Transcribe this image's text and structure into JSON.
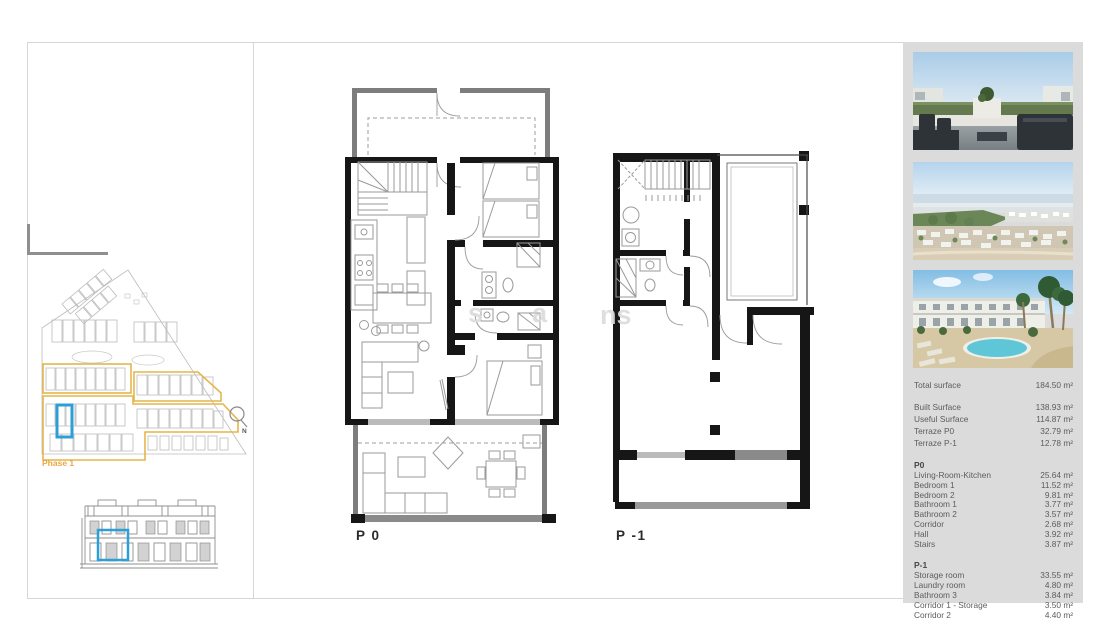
{
  "document": {
    "type": "floor-plan-sheet",
    "colors": {
      "highlight_blue": "#2D9FD6",
      "phase_yellow": "#E4B54B",
      "phase_text": "#E8A83E",
      "sidebar_background": "#DBDBDB",
      "wall_black": "#161616",
      "terrace_wall_gray": "#7D7D7D"
    }
  },
  "left_panel": {
    "site_plan": {
      "phase_label": "Phase 1",
      "compass_label": "N"
    }
  },
  "plans": {
    "p0_label": "P 0",
    "p1_label": "P -1"
  },
  "watermark": {
    "fragments": [
      "s",
      "a",
      "ns"
    ]
  },
  "sidebar": {
    "photos": [
      {
        "name": "rooftop-terrace-render"
      },
      {
        "name": "aerial-coastal-view"
      },
      {
        "name": "pool-and-townhouses-render"
      }
    ],
    "summary": {
      "total": {
        "label": "Total surface",
        "value": "184.50 m²"
      },
      "rows": [
        {
          "label": "Built Surface",
          "value": "138.93 m²"
        },
        {
          "label": "Useful Surface",
          "value": "114.87 m²"
        },
        {
          "label": "Terraze P0",
          "value": "32.79 m²"
        },
        {
          "label": "Terraze P-1",
          "value": "12.78 m²"
        }
      ]
    },
    "sections": [
      {
        "title": "P0",
        "rows": [
          {
            "label": "Living-Room-Kitchen",
            "value": "25.64 m²"
          },
          {
            "label": "Bedroom 1",
            "value": "11.52 m²"
          },
          {
            "label": "Bedroom 2",
            "value": "9.81 m²"
          },
          {
            "label": "Bathroom 1",
            "value": "3.77 m²"
          },
          {
            "label": "Bathroom 2",
            "value": "3.57 m²"
          },
          {
            "label": "Corridor",
            "value": "2.68 m²"
          },
          {
            "label": "Hall",
            "value": "3.92 m²"
          },
          {
            "label": "Stairs",
            "value": "3.87 m²"
          }
        ]
      },
      {
        "title": "P-1",
        "rows": [
          {
            "label": "Storage room",
            "value": "33.55 m²"
          },
          {
            "label": "Laundry room",
            "value": "4.80 m²"
          },
          {
            "label": "Bathroom 3",
            "value": "3.84 m²"
          },
          {
            "label": "Corridor 1 - Storage",
            "value": "3.50 m²"
          },
          {
            "label": "Corridor 2",
            "value": "4.40 m²"
          }
        ]
      }
    ]
  }
}
